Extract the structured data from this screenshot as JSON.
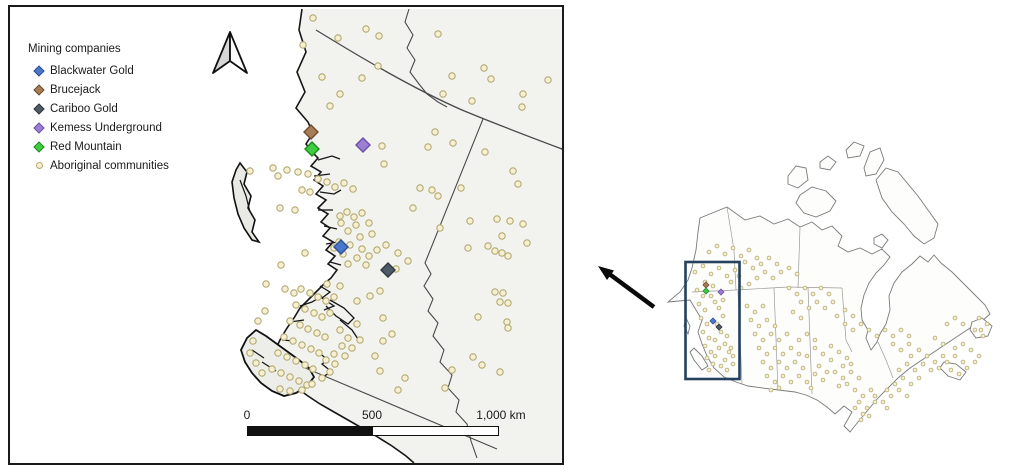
{
  "colors": {
    "frame": "#1a1a1a",
    "land": "#f2f2ef",
    "coast": "#161616",
    "border_line": "#4a4a4a",
    "community_fill": "#f6efd2",
    "community_stroke": "#b3ab72",
    "scale_segments": [
      "#111111",
      "#ffffff"
    ],
    "inset_outline": "#7a7a7a",
    "extent_rect": "#24425e",
    "arrow": "#0a0a0a",
    "north_arrow_left": "#d6d6d6",
    "north_arrow_right": "#ffffff"
  },
  "legend": {
    "title": "Mining companies",
    "items": [
      {
        "label": "Blackwater Gold",
        "shape": "diamond",
        "fill": "#4a77cc",
        "stroke": "#2d4f93"
      },
      {
        "label": "Brucejack",
        "shape": "diamond",
        "fill": "#a87c55",
        "stroke": "#6d4c2f"
      },
      {
        "label": "Cariboo Gold",
        "shape": "diamond",
        "fill": "#4e5a66",
        "stroke": "#30383f"
      },
      {
        "label": "Kemess Underground",
        "shape": "diamond",
        "fill": "#9b7fd4",
        "stroke": "#6a4fa3"
      },
      {
        "label": "Red Mountain",
        "shape": "diamond",
        "fill": "#3ecc41",
        "stroke": "#1e8a20"
      },
      {
        "label": "Aboriginal communities",
        "shape": "circle",
        "fill": "#f6efd2",
        "stroke": "#b3ab72"
      }
    ]
  },
  "scalebar": {
    "labels": [
      "0",
      "500",
      "1,000 km"
    ]
  },
  "main_map": {
    "mines": [
      {
        "company": "Brucejack",
        "x": 311,
        "y": 132,
        "fill": "#a87c55",
        "stroke": "#6d4c2f"
      },
      {
        "company": "Red Mountain",
        "x": 312,
        "y": 149,
        "fill": "#3ecc41",
        "stroke": "#1e8a20"
      },
      {
        "company": "Kemess Underground",
        "x": 363,
        "y": 145,
        "fill": "#9b7fd4",
        "stroke": "#6a4fa3"
      },
      {
        "company": "Blackwater Gold",
        "x": 341,
        "y": 247,
        "fill": "#4a77cc",
        "stroke": "#2d4f93"
      },
      {
        "company": "Cariboo Gold",
        "x": 388,
        "y": 270,
        "fill": "#4e5a66",
        "stroke": "#30383f"
      }
    ],
    "community_dots": [
      [
        313,
        18
      ],
      [
        366,
        29
      ],
      [
        438,
        34
      ],
      [
        303,
        45
      ],
      [
        338,
        38
      ],
      [
        379,
        36
      ],
      [
        340,
        94
      ],
      [
        362,
        78
      ],
      [
        378,
        66
      ],
      [
        322,
        77
      ],
      [
        452,
        76
      ],
      [
        484,
        68
      ],
      [
        491,
        79
      ],
      [
        443,
        94
      ],
      [
        472,
        101
      ],
      [
        523,
        94
      ],
      [
        522,
        107
      ],
      [
        435,
        132
      ],
      [
        428,
        147
      ],
      [
        453,
        143
      ],
      [
        485,
        152
      ],
      [
        513,
        171
      ],
      [
        518,
        184
      ],
      [
        548,
        80
      ],
      [
        330,
        106
      ],
      [
        382,
        146
      ],
      [
        384,
        164
      ],
      [
        287,
        170
      ],
      [
        278,
        176
      ],
      [
        298,
        172
      ],
      [
        308,
        174
      ],
      [
        318,
        179
      ],
      [
        327,
        182
      ],
      [
        335,
        187
      ],
      [
        344,
        183
      ],
      [
        353,
        189
      ],
      [
        302,
        190
      ],
      [
        310,
        192
      ],
      [
        295,
        210
      ],
      [
        280,
        208
      ],
      [
        273,
        168
      ],
      [
        250,
        171
      ],
      [
        305,
        253
      ],
      [
        281,
        265
      ],
      [
        340,
        216
      ],
      [
        347,
        212
      ],
      [
        354,
        217
      ],
      [
        362,
        213
      ],
      [
        341,
        223
      ],
      [
        356,
        225
      ],
      [
        369,
        223
      ],
      [
        348,
        231
      ],
      [
        360,
        237
      ],
      [
        372,
        234
      ],
      [
        339,
        242
      ],
      [
        350,
        245
      ],
      [
        362,
        249
      ],
      [
        343,
        254
      ],
      [
        334,
        248
      ],
      [
        357,
        258
      ],
      [
        369,
        256
      ],
      [
        348,
        264
      ],
      [
        377,
        250
      ],
      [
        366,
        265
      ],
      [
        386,
        245
      ],
      [
        398,
        253
      ],
      [
        408,
        261
      ],
      [
        396,
        269
      ],
      [
        420,
        188
      ],
      [
        432,
        190
      ],
      [
        438,
        196
      ],
      [
        413,
        208
      ],
      [
        440,
        228
      ],
      [
        470,
        221
      ],
      [
        497,
        219
      ],
      [
        510,
        221
      ],
      [
        523,
        224
      ],
      [
        502,
        236
      ],
      [
        527,
        243
      ],
      [
        488,
        246
      ],
      [
        495,
        251
      ],
      [
        502,
        253
      ],
      [
        508,
        256
      ],
      [
        468,
        248
      ],
      [
        461,
        188
      ],
      [
        495,
        292
      ],
      [
        503,
        293
      ],
      [
        500,
        302
      ],
      [
        508,
        303
      ],
      [
        478,
        317
      ],
      [
        507,
        322
      ],
      [
        508,
        328
      ],
      [
        473,
        357
      ],
      [
        482,
        365
      ],
      [
        500,
        372
      ],
      [
        445,
        388
      ],
      [
        452,
        370
      ],
      [
        327,
        284
      ],
      [
        340,
        286
      ],
      [
        357,
        301
      ],
      [
        370,
        296
      ],
      [
        380,
        291
      ],
      [
        357,
        324
      ],
      [
        383,
        318
      ],
      [
        392,
        334
      ],
      [
        383,
        341
      ],
      [
        375,
        356
      ],
      [
        380,
        371
      ],
      [
        405,
        378
      ],
      [
        398,
        390
      ],
      [
        266,
        284
      ],
      [
        285,
        289
      ],
      [
        294,
        293
      ],
      [
        301,
        289
      ],
      [
        310,
        293
      ],
      [
        318,
        297
      ],
      [
        326,
        301
      ],
      [
        334,
        297
      ],
      [
        296,
        305
      ],
      [
        305,
        309
      ],
      [
        314,
        313
      ],
      [
        322,
        317
      ],
      [
        330,
        313
      ],
      [
        290,
        321
      ],
      [
        300,
        325
      ],
      [
        308,
        329
      ],
      [
        317,
        333
      ],
      [
        325,
        337
      ],
      [
        284,
        337
      ],
      [
        293,
        341
      ],
      [
        302,
        345
      ],
      [
        311,
        349
      ],
      [
        319,
        353
      ],
      [
        278,
        353
      ],
      [
        287,
        357
      ],
      [
        296,
        361
      ],
      [
        305,
        365
      ],
      [
        313,
        369
      ],
      [
        272,
        369
      ],
      [
        281,
        373
      ],
      [
        290,
        377
      ],
      [
        299,
        381
      ],
      [
        307,
        385
      ],
      [
        290,
        391
      ],
      [
        280,
        389
      ],
      [
        262,
        373
      ],
      [
        256,
        363
      ],
      [
        250,
        353
      ],
      [
        253,
        341
      ],
      [
        258,
        321
      ],
      [
        265,
        311
      ],
      [
        340,
        330
      ],
      [
        348,
        338
      ],
      [
        342,
        346
      ],
      [
        334,
        354
      ],
      [
        326,
        360
      ],
      [
        335,
        364
      ],
      [
        345,
        356
      ],
      [
        352,
        348
      ],
      [
        360,
        340
      ],
      [
        330,
        372
      ],
      [
        322,
        378
      ],
      [
        312,
        384
      ],
      [
        302,
        390
      ]
    ]
  },
  "inset": {
    "extent_rect": {
      "x": 685.5,
      "y": 262,
      "w": 54,
      "h": 117
    },
    "mines": [
      {
        "company": "Brucejack",
        "x": 706,
        "y": 285,
        "fill": "#a87c55",
        "stroke": "#6d4c2f"
      },
      {
        "company": "Red Mountain",
        "x": 706,
        "y": 291,
        "fill": "#3ecc41",
        "stroke": "#1e8a20"
      },
      {
        "company": "Kemess Underground",
        "x": 721,
        "y": 292,
        "fill": "#9b7fd4",
        "stroke": "#6a4fa3"
      },
      {
        "company": "Blackwater Gold",
        "x": 713,
        "y": 321,
        "fill": "#4a77cc",
        "stroke": "#2d4f93"
      },
      {
        "company": "Cariboo Gold",
        "x": 719,
        "y": 327,
        "fill": "#4e5a66",
        "stroke": "#30383f"
      }
    ],
    "community_dots": [
      [
        697,
        290
      ],
      [
        703,
        296
      ],
      [
        699,
        304
      ],
      [
        705,
        310
      ],
      [
        701,
        318
      ],
      [
        707,
        324
      ],
      [
        703,
        332
      ],
      [
        709,
        338
      ],
      [
        705,
        346
      ],
      [
        711,
        352
      ],
      [
        707,
        358
      ],
      [
        713,
        364
      ],
      [
        709,
        370
      ],
      [
        715,
        356
      ],
      [
        719,
        348
      ],
      [
        715,
        340
      ],
      [
        721,
        332
      ],
      [
        717,
        324
      ],
      [
        723,
        316
      ],
      [
        719,
        308
      ],
      [
        725,
        344
      ],
      [
        729,
        352
      ],
      [
        725,
        360
      ],
      [
        731,
        348
      ],
      [
        727,
        336
      ],
      [
        733,
        356
      ],
      [
        721,
        366
      ],
      [
        727,
        370
      ],
      [
        733,
        364
      ],
      [
        715,
        302
      ],
      [
        711,
        296
      ],
      [
        723,
        300
      ],
      [
        695,
        272
      ],
      [
        703,
        266
      ],
      [
        711,
        274
      ],
      [
        719,
        268
      ],
      [
        727,
        276
      ],
      [
        735,
        270
      ],
      [
        731,
        282
      ],
      [
        739,
        276
      ],
      [
        705,
        282
      ],
      [
        713,
        286
      ],
      [
        709,
        252
      ],
      [
        717,
        246
      ],
      [
        725,
        254
      ],
      [
        733,
        248
      ],
      [
        741,
        256
      ],
      [
        749,
        250
      ],
      [
        757,
        258
      ],
      [
        745,
        262
      ],
      [
        753,
        268
      ],
      [
        761,
        264
      ],
      [
        769,
        258
      ],
      [
        777,
        264
      ],
      [
        765,
        272
      ],
      [
        773,
        278
      ],
      [
        781,
        272
      ],
      [
        757,
        278
      ],
      [
        749,
        284
      ],
      [
        741,
        288
      ],
      [
        789,
        268
      ],
      [
        797,
        274
      ],
      [
        747,
        306
      ],
      [
        755,
        312
      ],
      [
        763,
        306
      ],
      [
        751,
        320
      ],
      [
        759,
        326
      ],
      [
        767,
        320
      ],
      [
        775,
        326
      ],
      [
        755,
        334
      ],
      [
        763,
        340
      ],
      [
        771,
        334
      ],
      [
        779,
        340
      ],
      [
        787,
        334
      ],
      [
        759,
        348
      ],
      [
        767,
        354
      ],
      [
        775,
        348
      ],
      [
        783,
        354
      ],
      [
        791,
        348
      ],
      [
        799,
        354
      ],
      [
        763,
        362
      ],
      [
        771,
        368
      ],
      [
        779,
        362
      ],
      [
        787,
        368
      ],
      [
        795,
        362
      ],
      [
        803,
        368
      ],
      [
        767,
        376
      ],
      [
        775,
        382
      ],
      [
        783,
        376
      ],
      [
        791,
        382
      ],
      [
        799,
        376
      ],
      [
        807,
        382
      ],
      [
        771,
        390
      ],
      [
        779,
        388
      ],
      [
        815,
        374
      ],
      [
        823,
        380
      ],
      [
        811,
        388
      ],
      [
        819,
        366
      ],
      [
        827,
        372
      ],
      [
        807,
        356
      ],
      [
        815,
        348
      ],
      [
        823,
        354
      ],
      [
        831,
        360
      ],
      [
        799,
        340
      ],
      [
        807,
        334
      ],
      [
        815,
        340
      ],
      [
        831,
        346
      ],
      [
        839,
        352
      ],
      [
        847,
        358
      ],
      [
        843,
        366
      ],
      [
        851,
        364
      ],
      [
        835,
        372
      ],
      [
        843,
        378
      ],
      [
        851,
        372
      ],
      [
        859,
        378
      ],
      [
        839,
        386
      ],
      [
        847,
        384
      ],
      [
        855,
        390
      ],
      [
        863,
        396
      ],
      [
        871,
        390
      ],
      [
        859,
        402
      ],
      [
        867,
        408
      ],
      [
        875,
        402
      ],
      [
        863,
        414
      ],
      [
        861,
        420
      ],
      [
        869,
        416
      ],
      [
        887,
        408
      ],
      [
        875,
        396
      ],
      [
        883,
        402
      ],
      [
        855,
        408
      ],
      [
        891,
        396
      ],
      [
        899,
        390
      ],
      [
        907,
        396
      ],
      [
        895,
        384
      ],
      [
        903,
        378
      ],
      [
        911,
        384
      ],
      [
        919,
        378
      ],
      [
        899,
        370
      ],
      [
        907,
        364
      ],
      [
        915,
        370
      ],
      [
        923,
        364
      ],
      [
        931,
        370
      ],
      [
        911,
        356
      ],
      [
        919,
        350
      ],
      [
        927,
        356
      ],
      [
        887,
        390
      ],
      [
        935,
        362
      ],
      [
        943,
        356
      ],
      [
        939,
        368
      ],
      [
        947,
        362
      ],
      [
        955,
        356
      ],
      [
        963,
        362
      ],
      [
        951,
        370
      ],
      [
        959,
        374
      ],
      [
        967,
        368
      ],
      [
        975,
        362
      ],
      [
        955,
        348
      ],
      [
        963,
        344
      ],
      [
        971,
        350
      ],
      [
        979,
        356
      ],
      [
        943,
        344
      ],
      [
        935,
        338
      ],
      [
        947,
        324
      ],
      [
        955,
        318
      ],
      [
        963,
        324
      ],
      [
        975,
        330
      ],
      [
        981,
        330
      ],
      [
        983,
        336
      ],
      [
        987,
        324
      ],
      [
        979,
        318
      ],
      [
        789,
        288
      ],
      [
        797,
        294
      ],
      [
        805,
        288
      ],
      [
        813,
        294
      ],
      [
        821,
        288
      ],
      [
        829,
        294
      ],
      [
        801,
        302
      ],
      [
        809,
        308
      ],
      [
        817,
        302
      ],
      [
        825,
        308
      ],
      [
        833,
        302
      ],
      [
        793,
        312
      ],
      [
        801,
        318
      ],
      [
        837,
        316
      ],
      [
        845,
        310
      ],
      [
        853,
        316
      ],
      [
        845,
        324
      ],
      [
        853,
        330
      ],
      [
        861,
        324
      ],
      [
        869,
        330
      ],
      [
        877,
        336
      ],
      [
        885,
        330
      ],
      [
        893,
        336
      ],
      [
        901,
        330
      ],
      [
        909,
        336
      ],
      [
        893,
        344
      ],
      [
        901,
        350
      ],
      [
        909,
        344
      ]
    ]
  }
}
